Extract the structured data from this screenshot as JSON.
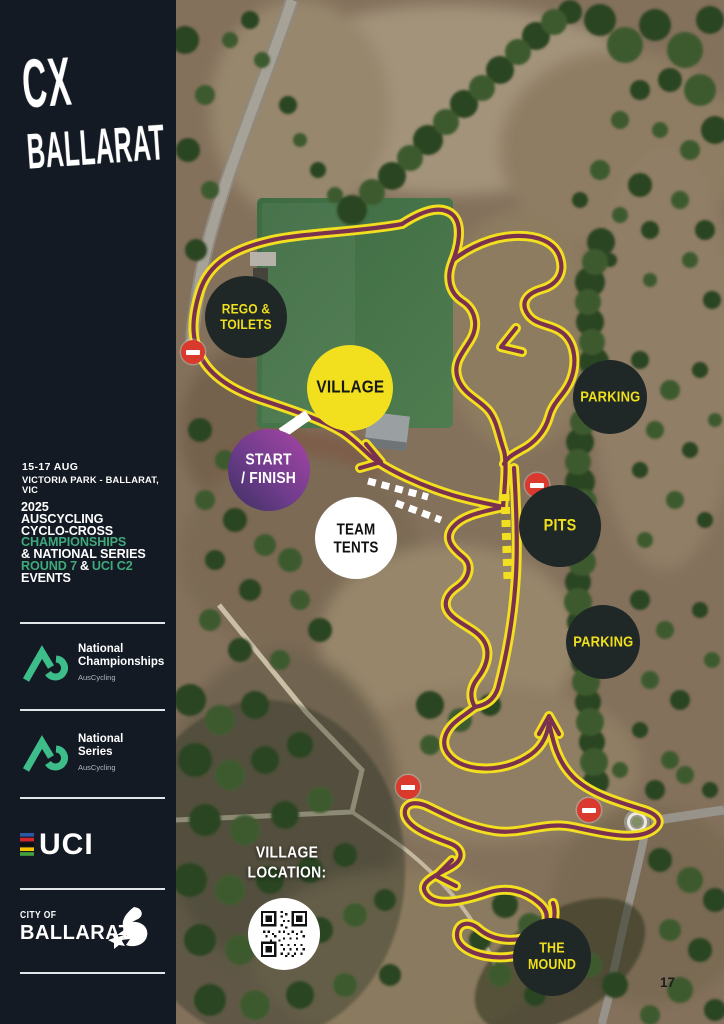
{
  "page_number": "17",
  "sidebar": {
    "logo": {
      "top": "CX",
      "bottom": "BALLARAT"
    },
    "event": {
      "dates": "15-17 AUG",
      "venue": "VICTORIA PARK - BALLARAT, VIC"
    },
    "title_lines": {
      "l1": "2025",
      "l2": "AUSCYCLING",
      "l3": "CYCLO-CROSS",
      "l4": "CHAMPIONSHIPS",
      "l5": "& NATIONAL SERIES",
      "l6a": "ROUND 7",
      "l6b": "&",
      "l6c": "UCI C2",
      "l7": "EVENTS"
    },
    "partners": {
      "championships": {
        "line1": "National",
        "line2": "Championships",
        "sub": "AusCycling"
      },
      "series": {
        "line1": "National",
        "line2": "Series",
        "sub": "AusCycling"
      }
    },
    "uci_label": "UCI",
    "city_of_ballarat": {
      "small": "CITY OF",
      "big": "BALLARAT"
    }
  },
  "map": {
    "badges": {
      "rego": "REGO &\nTOILETS",
      "village": "VILLAGE",
      "start_finish": "START\n/ FINISH",
      "team_tents": "TEAM TENTS",
      "parking_north": "PARKING",
      "pits": "PITS",
      "parking_south": "PARKING",
      "the_mound": "THE MOUND"
    },
    "village_location_label": "VILLAGE\nLOCATION:"
  },
  "colors": {
    "sidebar_bg": "#131A23",
    "accent_yellow": "#F2E01E",
    "course_maroon": "#7A3150",
    "badge_dark": "#1F2827",
    "start_purple_light": "#A845A5",
    "start_purple_dark": "#3C3061",
    "green_accent": "#3FA97C",
    "auscycling_green": "#3DBD8A",
    "no_entry_red": "#D93A2D",
    "field_green": "#477548"
  }
}
